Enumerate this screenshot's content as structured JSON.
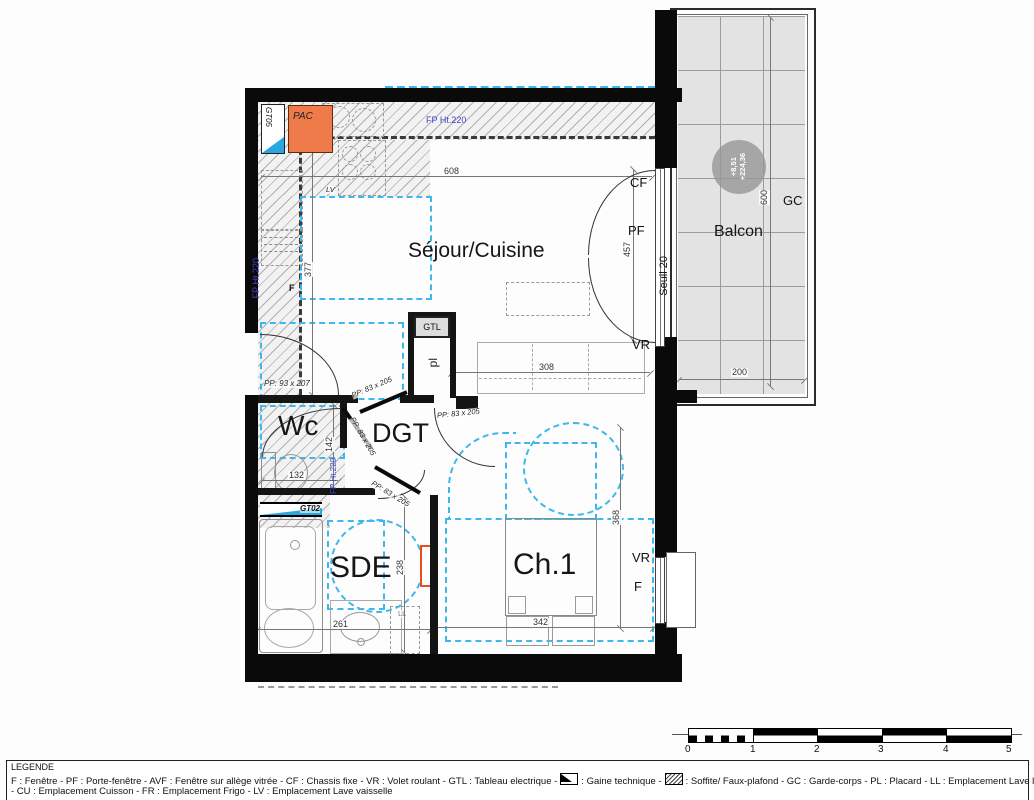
{
  "rooms": {
    "sejour": "Séjour/Cuisine",
    "wc": "Wc",
    "dgt": "DGT",
    "sde": "SDE",
    "ch1": "Ch.1",
    "balcon": "Balcon"
  },
  "labels": {
    "pac": "PAC",
    "gtl": "GTL",
    "pl": "pl",
    "gt05": "GT05",
    "gt02": "GT02",
    "cf": "CF",
    "pf": "PF",
    "vr": "VR",
    "f": "F",
    "gc": "GC",
    "ll": "LL",
    "lv": "LV",
    "seuil": "Seuil 20",
    "fp_ht220": "FP Ht.220",
    "level_line1": "+8,51",
    "level_line2": "+224,36"
  },
  "doors": {
    "entrance": "PP: 93 x 207",
    "interior": "PP: 83 x 205"
  },
  "dimensions": {
    "sejour_w": "608",
    "sejour_left_h": "377",
    "bay_h": "457",
    "couch_w": "308",
    "wc_h": "142",
    "wc_w": "132",
    "sde_h": "238",
    "sde_w": "261",
    "ch1_h": "368",
    "bed_w": "342",
    "balcon_h": "600",
    "balcon_w": "200"
  },
  "legend": {
    "title": "LEGENDE",
    "line1_a": "F : Fenêtre - PF : Porte-fenêtre - AVF : Fenêtre sur allège vitrée - CF : Chassis fixe - VR : Volet roulant - GTL : Tableau electrique -",
    "line1_b": ": Gaine technique -",
    "line1_c": ": Soffite/ Faux-plafond - GC : Garde-corps - PL : Placard - LL : Emplacement Lave linge",
    "line2": "- CU : Emplacement Cuisson - FR : Emplacement Frigo - LV : Emplacement Lave vaisselle"
  },
  "scalebar": {
    "ticks": [
      "0",
      "1",
      "2",
      "3",
      "4",
      "5"
    ]
  }
}
